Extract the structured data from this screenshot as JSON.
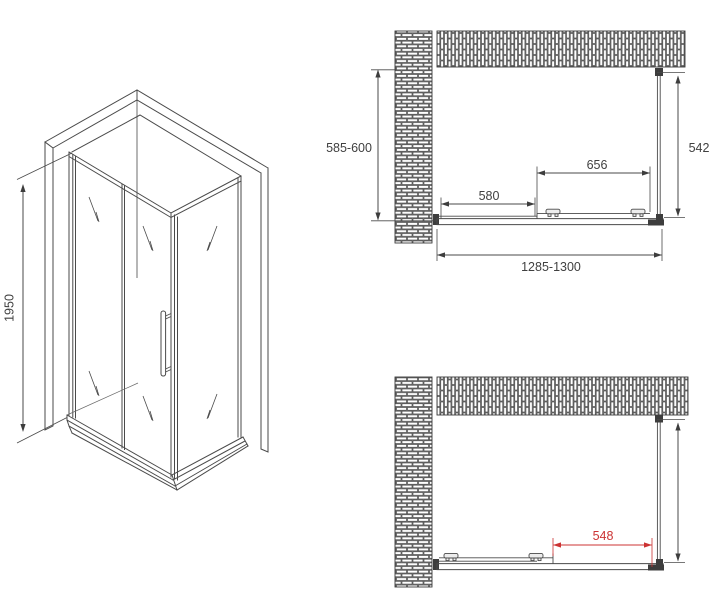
{
  "drawing": {
    "type": "shower-enclosure-technical-drawing",
    "isometric": {
      "height_label": "1950"
    },
    "plan_top": {
      "depth_range_label": "585-600",
      "glass_depth_label": "542",
      "door_width_label": "656",
      "fixed_panel_width_label": "580",
      "overall_width_label": "1285-1300"
    },
    "plan_bottom": {
      "opening_width_label": "548"
    }
  },
  "colors": {
    "line": "#4a4a4a",
    "text": "#404040",
    "dimension_red": "#cc3333",
    "brick_mortar": "#8a8a8a",
    "background": "#ffffff"
  }
}
